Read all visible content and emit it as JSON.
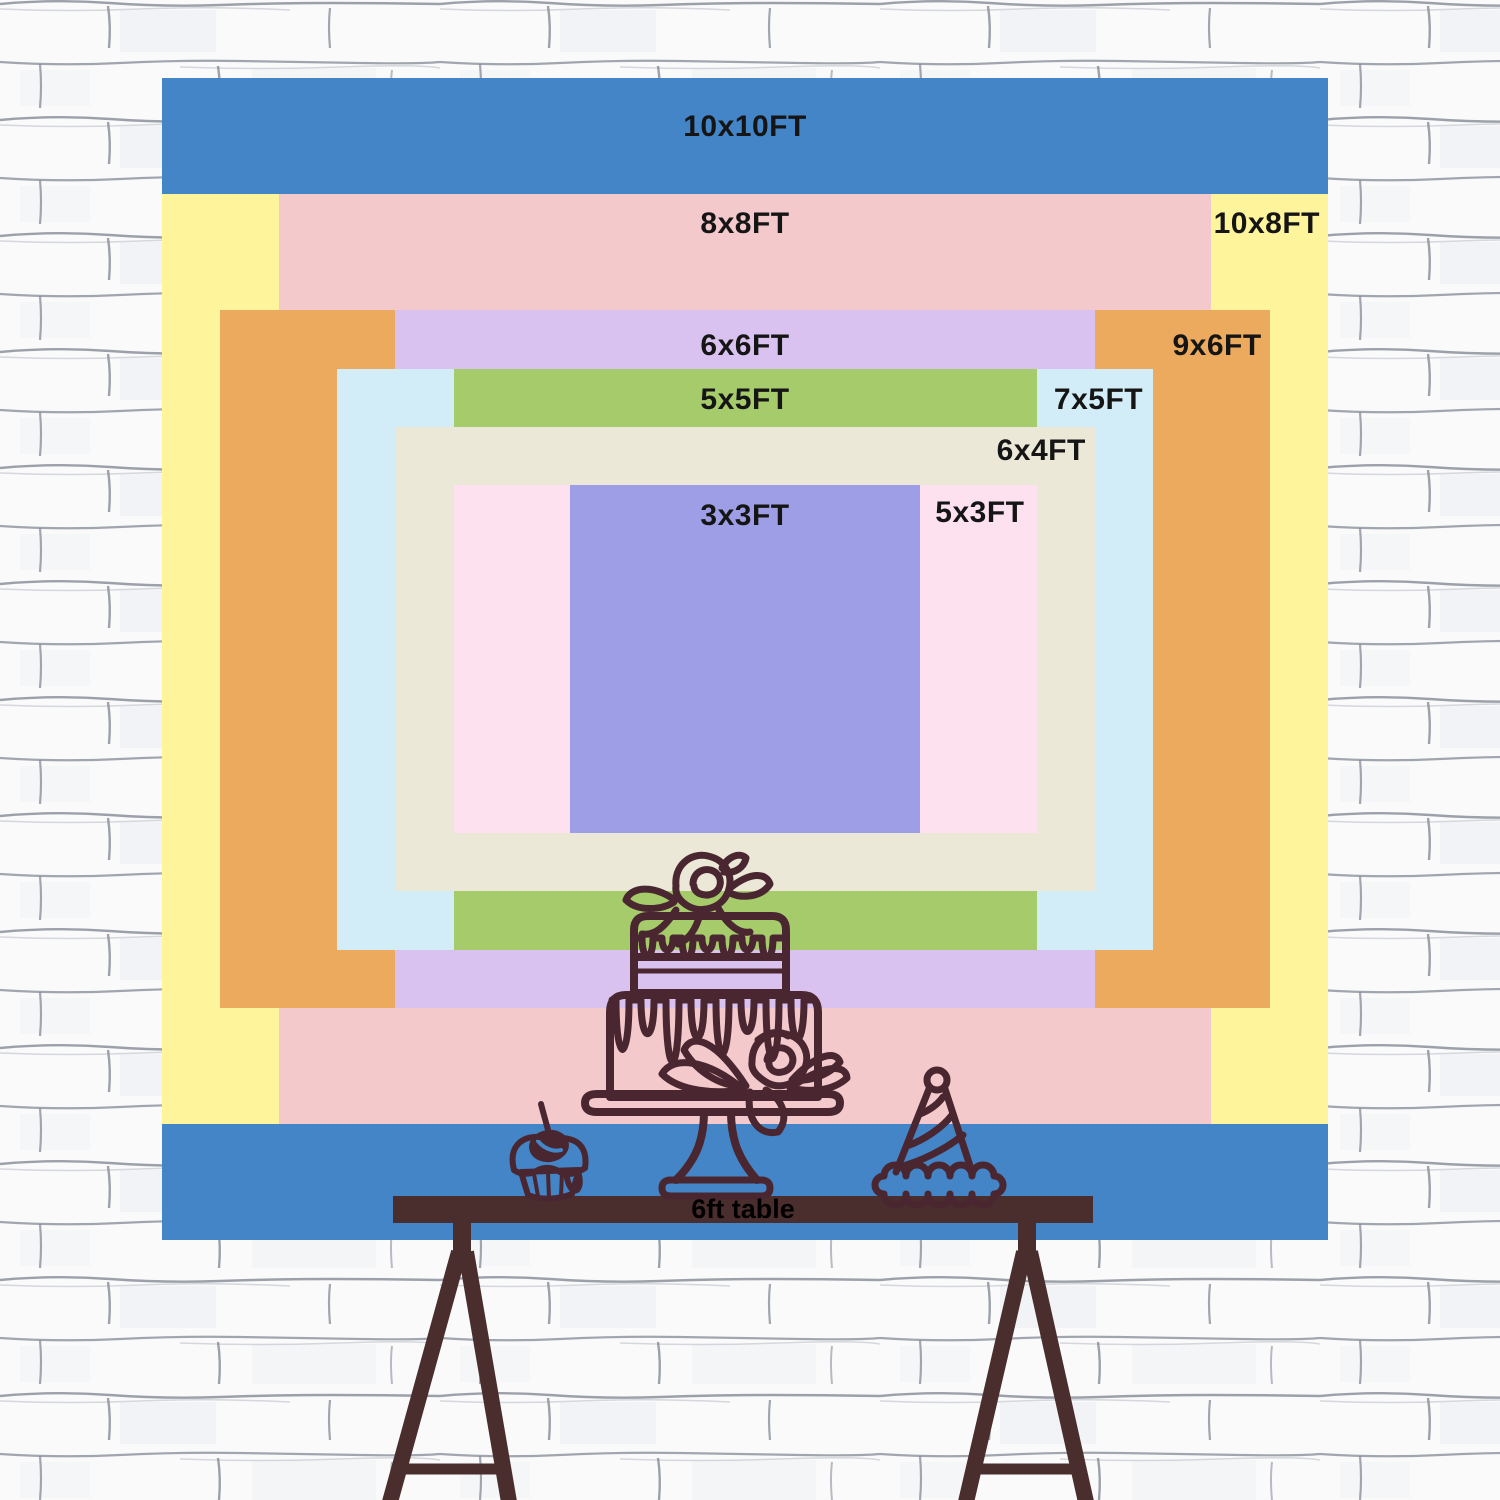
{
  "title": "Backdrop size comparison chart",
  "wall": {
    "base_color": "#fafafb",
    "mortar_line_color": "#8b919b"
  },
  "backdrop": {
    "label_color": "#151515",
    "sizes": [
      {
        "label": "10x10FT",
        "w_ft": 10,
        "h_ft": 10,
        "color": "#4385c7",
        "anchor": "center",
        "dx": 0,
        "dy": 32
      },
      {
        "label": "10x8FT",
        "w_ft": 10,
        "h_ft": 8,
        "color": "#fdf49b",
        "anchor": "right",
        "dx": 8,
        "dy": 13
      },
      {
        "label": "8x8FT",
        "w_ft": 8,
        "h_ft": 8,
        "color": "#f3c9cb",
        "anchor": "center",
        "dx": 0,
        "dy": 13
      },
      {
        "label": "9x6FT",
        "w_ft": 9,
        "h_ft": 6,
        "color": "#ebaa5d",
        "anchor": "right",
        "dx": 8,
        "dy": 19
      },
      {
        "label": "6x6FT",
        "w_ft": 6,
        "h_ft": 6,
        "color": "#d9c2ef",
        "anchor": "center",
        "dx": 0,
        "dy": 19
      },
      {
        "label": "7x5FT",
        "w_ft": 7,
        "h_ft": 5,
        "color": "#d2edf7",
        "anchor": "right",
        "dx": 10,
        "dy": 14
      },
      {
        "label": "5x5FT",
        "w_ft": 5,
        "h_ft": 5,
        "color": "#a6cb6b",
        "anchor": "center",
        "dx": 0,
        "dy": 14
      },
      {
        "label": "6x4FT",
        "w_ft": 6,
        "h_ft": 4,
        "color": "#ebe8d8",
        "anchor": "right",
        "dx": 9,
        "dy": 7
      },
      {
        "label": "5x3FT",
        "w_ft": 5,
        "h_ft": 3,
        "color": "#fde1ef",
        "anchor": "right",
        "dx": 12,
        "dy": 11
      },
      {
        "label": "3x3FT",
        "w_ft": 3,
        "h_ft": 3,
        "color": "#9e9ee6",
        "anchor": "center",
        "dx": 0,
        "dy": 14
      }
    ]
  },
  "table": {
    "label": "6ft table",
    "color": "#4a2e2d"
  },
  "illustration": {
    "stroke_color": "#4a2730",
    "items": [
      "cupcake-icon",
      "tiered-cake-icon",
      "party-hat-icon"
    ]
  }
}
